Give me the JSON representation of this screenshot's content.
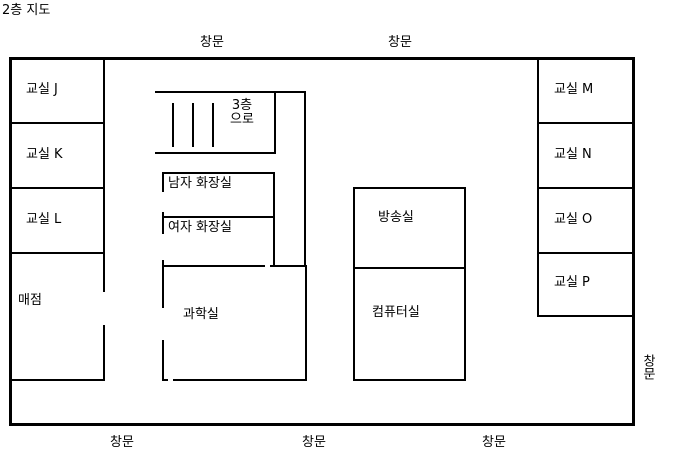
{
  "title": "2층 지도",
  "rooms": {
    "classroom_j": {
      "label": "교실 J"
    },
    "classroom_k": {
      "label": "교실 K"
    },
    "classroom_l": {
      "label": "교실 L"
    },
    "store": {
      "label": "매점"
    },
    "stairs": {
      "label": "3층 으로",
      "line1": "3층",
      "line2": "으로"
    },
    "mens_restroom": {
      "label": "남자 화장실"
    },
    "womens_restroom": {
      "label": "여자 화장실"
    },
    "science_room": {
      "label": "과학실"
    },
    "broadcast_room": {
      "label": "방송실"
    },
    "computer_room": {
      "label": "컴퓨터실"
    },
    "classroom_m": {
      "label": "교실 M"
    },
    "classroom_n": {
      "label": "교실 N"
    },
    "classroom_o": {
      "label": "교실 O"
    },
    "classroom_p": {
      "label": "교실 P"
    }
  },
  "windows": {
    "top_1": "창문",
    "top_2": "창문",
    "bottom_1": "창문",
    "bottom_2": "창문",
    "bottom_3": "창문",
    "right": "창문"
  },
  "colors": {
    "line": "#000000",
    "background": "#ffffff"
  }
}
